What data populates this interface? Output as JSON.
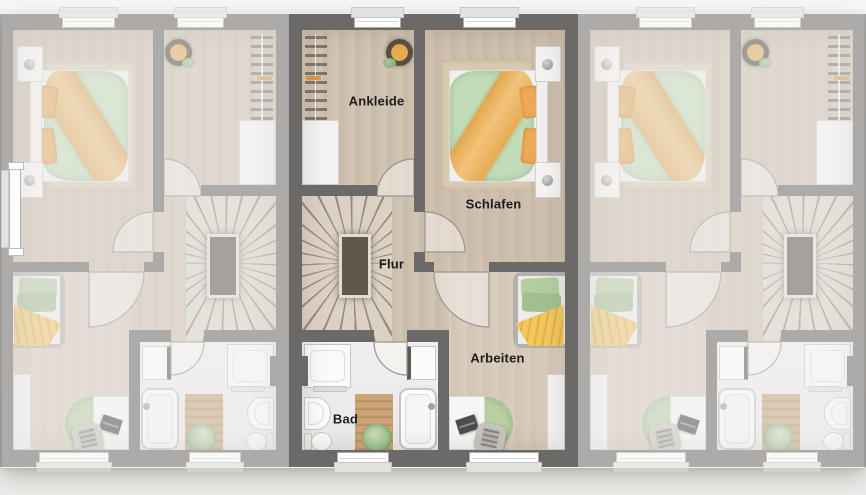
{
  "floorplan": {
    "view": "upper-floor-plan",
    "highlighted_unit": "middle",
    "rooms": [
      {
        "id": "ankleide",
        "label": "Ankleide"
      },
      {
        "id": "schlafen",
        "label": "Schlafen"
      },
      {
        "id": "flur",
        "label": "Flur"
      },
      {
        "id": "arbeiten",
        "label": "Arbeiten"
      },
      {
        "id": "bad",
        "label": "Bad"
      }
    ],
    "units": [
      {
        "id": "left",
        "state": "inactive",
        "mirrored": true
      },
      {
        "id": "middle",
        "state": "active",
        "mirrored": false
      },
      {
        "id": "right",
        "state": "inactive",
        "mirrored": true
      }
    ],
    "colors": {
      "background": "#f5f4f2",
      "wall": "#6c6a68",
      "floor_wood": "#cec0af",
      "floor_bath": "#ededec",
      "stair_void": "#60574d",
      "bedding_green": "#c2dcb8",
      "blanket_orange": "#edb869",
      "blanket_yellow": "#f3c75e",
      "rug_round_green": "#b7cfa2",
      "wood_mat": "#c9a475"
    },
    "furniture": {
      "ankleide": [
        "wardrobe-rack",
        "cabinet",
        "potted-plant"
      ],
      "schlafen": [
        "double-bed",
        "nightstand",
        "nightstand",
        "rug"
      ],
      "flur": [
        "winder-staircase"
      ],
      "bad": [
        "shower",
        "vanity-cabinet",
        "sink",
        "toilet",
        "bathtub",
        "wood-mat",
        "plant",
        "towel-bar"
      ],
      "arbeiten": [
        "daybed",
        "desk",
        "laptop",
        "office-chair",
        "round-rug",
        "sideboard"
      ]
    }
  }
}
